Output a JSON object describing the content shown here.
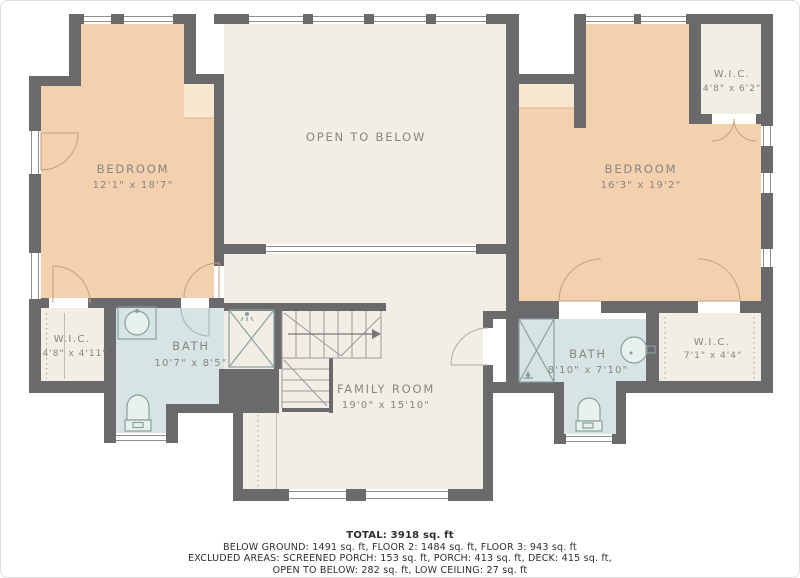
{
  "colors": {
    "wall": "#6a696b",
    "peach": "#f3d0ae",
    "peach_pale": "#f9e6ce",
    "cream": "#f2eee6",
    "bath": "#d6e5e3",
    "label": "#8b8480"
  },
  "rooms": {
    "bedroom_left": {
      "name": "BEDROOM",
      "dims": "12'1\" x 18'7\""
    },
    "open_below": {
      "name": "OPEN TO BELOW"
    },
    "bedroom_right": {
      "name": "BEDROOM",
      "dims": "16'3\" x 19'2\""
    },
    "wic_top_right": {
      "name": "W.I.C.",
      "dims": "4'8\" x 6'2\""
    },
    "wic_left": {
      "name": "W.I.C.",
      "dims": "4'8\" x 4'11\""
    },
    "bath_left": {
      "name": "BATH",
      "dims": "10'7\" x 8'5\""
    },
    "family_room": {
      "name": "FAMILY ROOM",
      "dims": "19'0\" x 15'10\""
    },
    "bath_right": {
      "name": "BATH",
      "dims": "8'10\" x 7'10\""
    },
    "wic_right": {
      "name": "W.I.C.",
      "dims": "7'1\" x 4'4\""
    }
  },
  "summary": {
    "total": "TOTAL: 3918 sq. ft",
    "floors": "BELOW GROUND: 1491 sq. ft, FLOOR 2: 1484 sq. ft, FLOOR 3: 943 sq. ft",
    "excluded": "EXCLUDED AREAS: SCREENED PORCH: 153 sq. ft, PORCH: 413 sq. ft, DECK: 415 sq. ft,",
    "excluded2": "OPEN TO BELOW: 282 sq. ft, LOW CEILING: 27 sq. ft"
  }
}
